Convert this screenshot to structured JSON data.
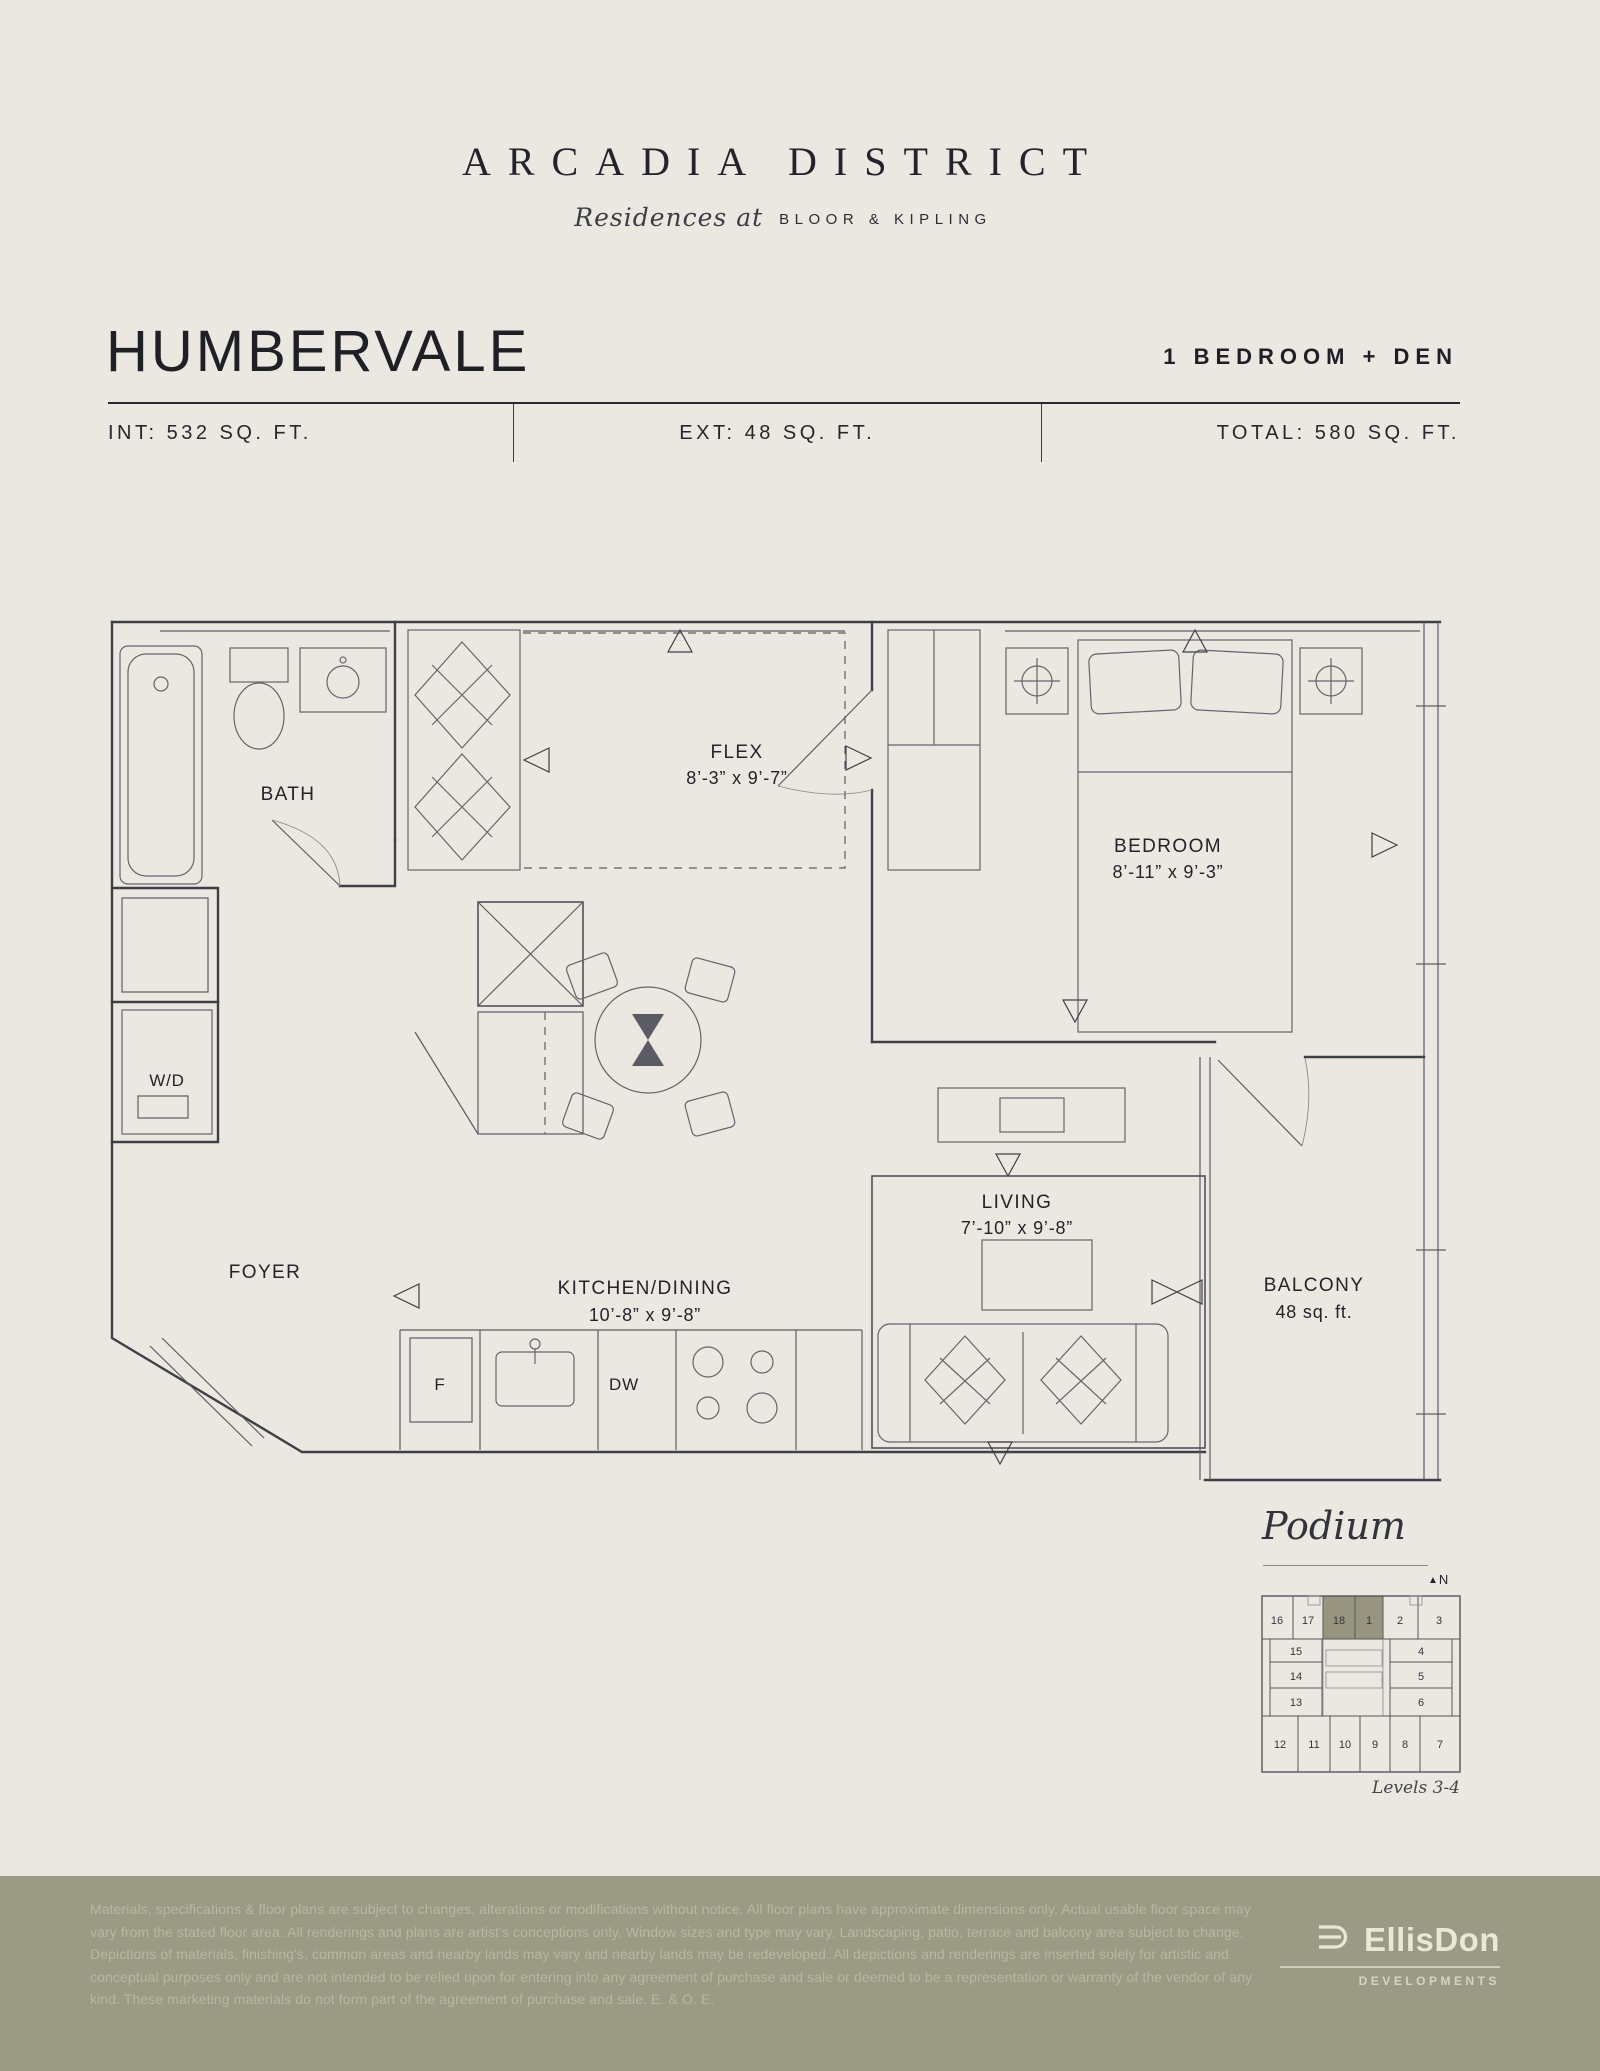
{
  "brand": {
    "title": "ARCADIA DISTRICT",
    "tagline_script": "Residences at",
    "tagline_rest": "BLOOR & KIPLING"
  },
  "plan": {
    "name": "HUMBERVALE",
    "unit_type": "1 BEDROOM + DEN",
    "stats": {
      "interior": "INT: 532 SQ. FT.",
      "exterior": "EXT: 48 SQ. FT.",
      "total": "TOTAL: 580 SQ. FT."
    }
  },
  "floorplan": {
    "rooms": {
      "bath": {
        "name": "BATH"
      },
      "wd": {
        "name": "W/D"
      },
      "foyer": {
        "name": "FOYER"
      },
      "flex": {
        "name": "FLEX",
        "dims": "8’-3” x 9’-7”"
      },
      "bedroom": {
        "name": "BEDROOM",
        "dims": "8’-11” x 9’-3”"
      },
      "kitchen": {
        "name": "KITCHEN/DINING",
        "dims": "10’-8” x 9’-8”"
      },
      "living": {
        "name": "LIVING",
        "dims": "7’-10” x 9’-8”"
      },
      "balcony": {
        "name": "BALCONY",
        "area": "48 sq. ft."
      },
      "fridge": {
        "name": "F"
      },
      "dishwasher": {
        "name": "DW"
      }
    }
  },
  "keyplan": {
    "title": "Podium",
    "north_label": "N",
    "levels": "Levels 3-4",
    "highlight_color": "#97957f",
    "highlighted_units": [
      "18",
      "1"
    ],
    "units": [
      "16",
      "17",
      "18",
      "1",
      "2",
      "3",
      "15",
      "14",
      "13",
      "4",
      "5",
      "6",
      "12",
      "11",
      "10",
      "9",
      "8",
      "7"
    ]
  },
  "footer": {
    "background": "#9b9a85",
    "disclaimer": "Materials, specifications & floor plans are subject to changes, alterations or modifications without notice. All floor plans have approximate dimensions only. Actual usable floor space may vary from the stated floor area. All renderings and plans are artist's conceptions only. Window sizes and type may vary. Landscaping, patio, terrace and balcony area subject to change. Depictions of materials, finishing's, common areas and nearby lands may vary and nearby lands may be redeveloped. All depictions and renderings are inserted solely for artistic and conceptual purposes only and are not intended to be relied upon for entering into any agreement of purchase and sale or deemed to be a representation or warranty of the vendor of any kind. These marketing materials do not form part of the agreement of purchase and sale. E. & O. E.",
    "logo_text": "EllisDon",
    "logo_sub": "DEVELOPMENTS"
  }
}
